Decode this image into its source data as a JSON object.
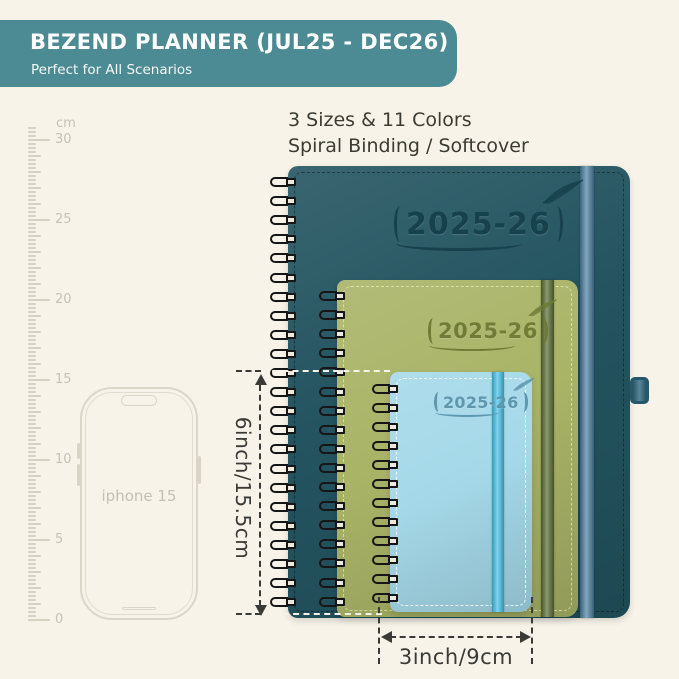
{
  "page": {
    "background": "#f7f3e9"
  },
  "header": {
    "title": "BEZEND PLANNER (JUL25 - DEC26)",
    "subtitle": "Perfect for All Scenarios",
    "bg_color": "#4c8b93",
    "text_color": "#ffffff"
  },
  "info": {
    "line1": "3 Sizes & 11 Colors",
    "line2": "Spiral Binding / Softcover"
  },
  "ruler": {
    "unit": "cm",
    "labels": [
      {
        "value": 30,
        "label": "30"
      },
      {
        "value": 25,
        "label": "25"
      },
      {
        "value": 20,
        "label": "20"
      },
      {
        "value": 15,
        "label": "15"
      },
      {
        "value": 10,
        "label": "10"
      },
      {
        "value": 5,
        "label": "5"
      },
      {
        "value": 0,
        "label": "0"
      }
    ]
  },
  "phone": {
    "label": "iphone 15"
  },
  "planners": [
    {
      "id": "large",
      "year_label": "2025-26",
      "colors": {
        "cover": "#235460",
        "band": "#4a80a0",
        "emboss": "#16404b",
        "pen_loop": "#346c80"
      }
    },
    {
      "id": "medium",
      "year_label": "2025-26",
      "colors": {
        "cover": "#a9b467",
        "band": "#5a6c30",
        "emboss": "#6e7a34"
      }
    },
    {
      "id": "small",
      "year_label": "2025-26",
      "colors": {
        "cover": "#a5d9e9",
        "band": "#48c1ec",
        "emboss": "#5b95ab"
      }
    }
  ],
  "dimensions": {
    "height_label": "6inch/15.5cm",
    "width_label": "3inch/9cm",
    "annotation_color": "#3a3a36"
  }
}
